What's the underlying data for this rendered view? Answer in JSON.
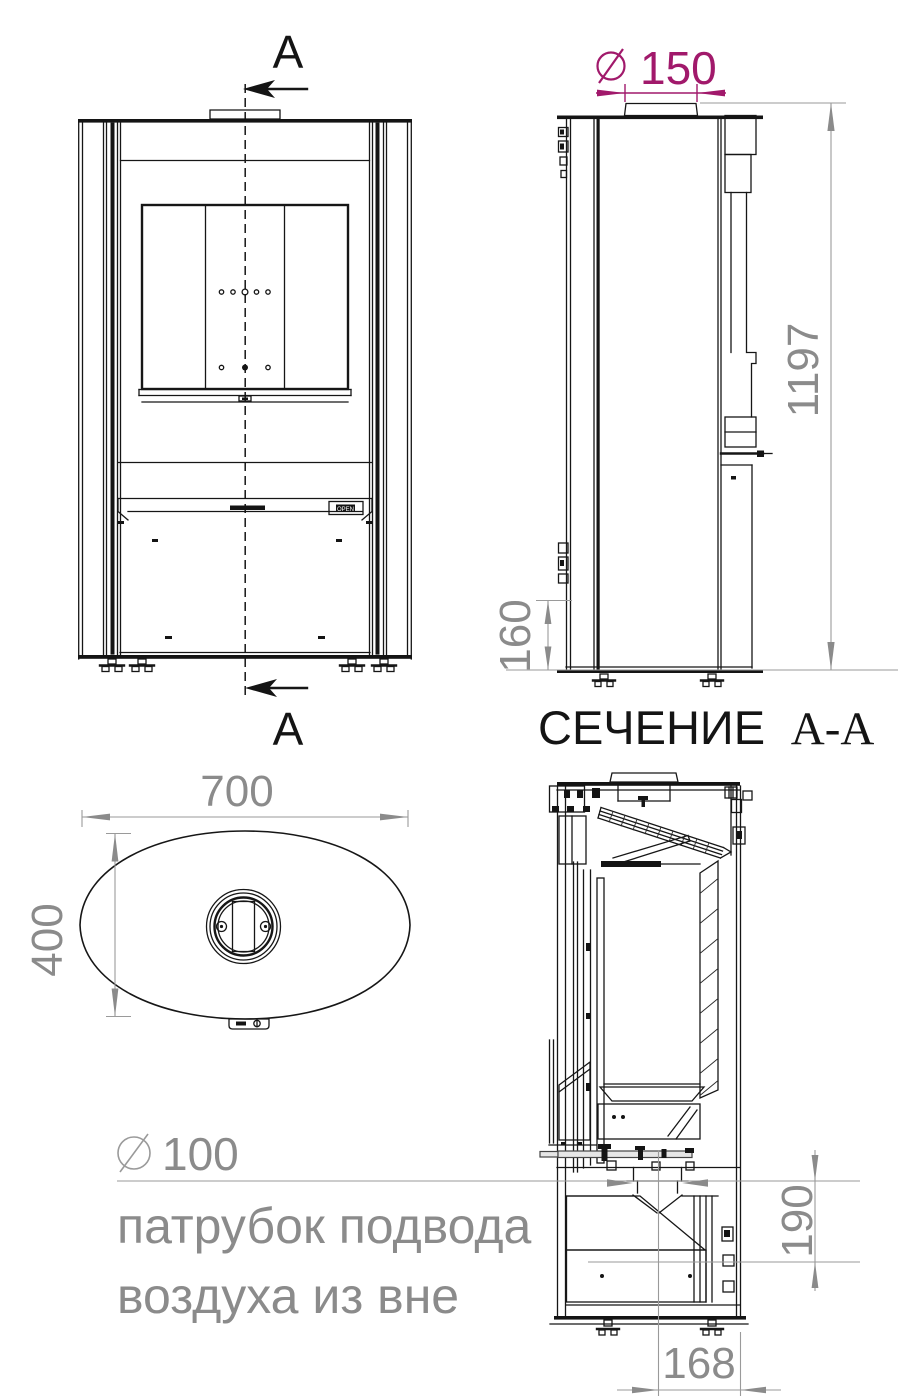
{
  "page": {
    "background": "#ffffff"
  },
  "views": {
    "front": {
      "section_label_top": "A",
      "section_label_bottom": "A",
      "open_badge": "OPEN"
    },
    "side": {
      "flue_diameter_value": "150",
      "overall_height": "1197",
      "base_height": "160"
    },
    "section_title": {
      "main": "СЕЧЕНИЕ",
      "ref": "А-А"
    },
    "top": {
      "width": "700",
      "depth": "400"
    },
    "section": {
      "air_inlet_diameter_value": "100",
      "air_note_line1": "патрубок подвода",
      "air_note_line2": "воздуха из вне",
      "inlet_height": "190",
      "inlet_offset": "168"
    }
  },
  "colors": {
    "accent_magenta": "#a1196b",
    "dimension_gray": "#8b8b8b",
    "line_black": "#141414"
  }
}
